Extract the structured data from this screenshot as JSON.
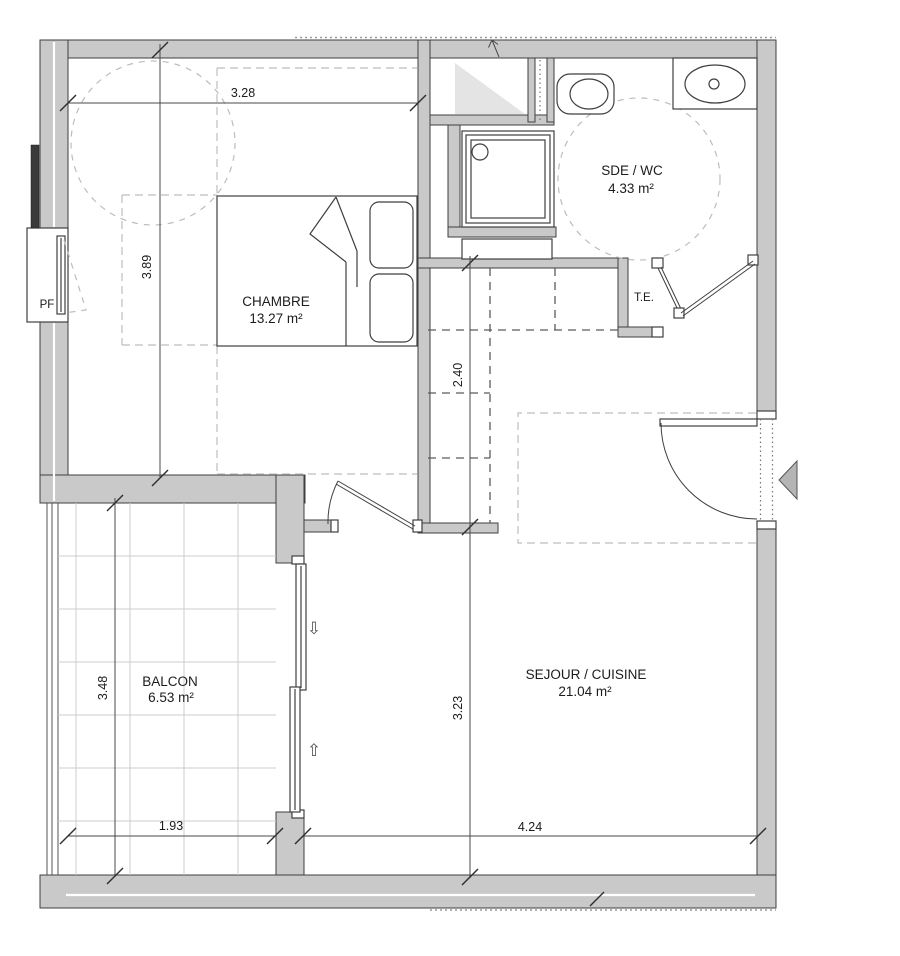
{
  "rooms": {
    "chambre": {
      "name": "CHAMBRE",
      "area": "13.27 m²"
    },
    "sde_wc": {
      "name": "SDE / WC",
      "area": "4.33 m²"
    },
    "te": {
      "name": "T.E."
    },
    "sejour_cuisine": {
      "name": "SEJOUR / CUISINE",
      "area": "21.04 m²"
    },
    "balcon": {
      "name": "BALCON",
      "area": "6.53 m²"
    }
  },
  "window": {
    "label": "PF"
  },
  "dimensions": {
    "chambre_width": "3.28",
    "chambre_depth": "3.89",
    "entry_depth": "2.40",
    "balcon_depth": "3.48",
    "balcon_width": "1.93",
    "sejour_depth": "3.23",
    "sejour_width": "4.24"
  },
  "icons": {
    "slide_down_arrow": "⇩",
    "slide_up_arrow": "⇧"
  },
  "colors": {
    "wall_fill": "#c9c9c9",
    "line": "#3f3f3f",
    "dash_light": "#bdbdbd",
    "dash_dark": "#5a5a5a",
    "shade": "#e4e4e4",
    "arrow_fill": "#b5b5b5"
  }
}
